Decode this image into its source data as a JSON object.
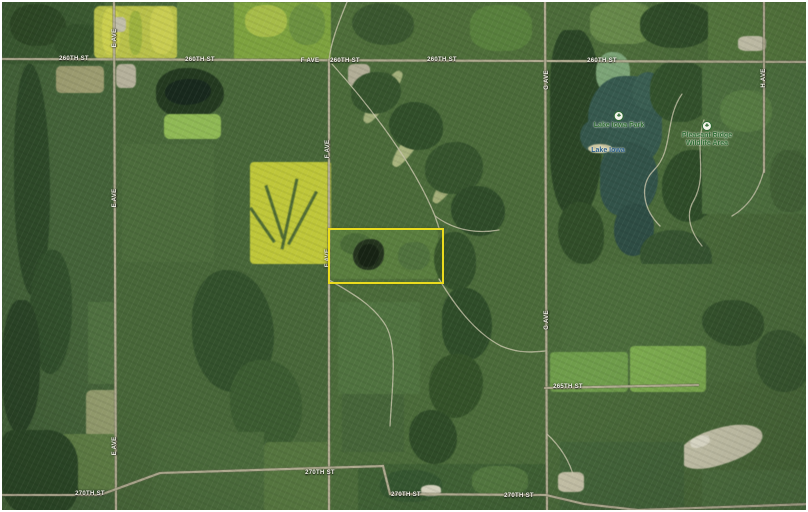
{
  "map": {
    "width": 808,
    "height": 512,
    "background_color": "#486739",
    "parcel": {
      "label": "highlighted-parcel",
      "x": 326,
      "y": 226,
      "w": 112,
      "h": 52,
      "border_color": "#eadb1e"
    },
    "road_color": "#b3ae94",
    "road_casing_color": "#6e6e59",
    "trail_color": "#c8c5ab",
    "roads_major": [
      "M0,57 L808,60",
      "M112,0 L114,512",
      "M327,58 L327,512",
      "M543,0 L545,512",
      "M762,0 L762,170",
      "M543,386 L696,383",
      "M0,493 L98,493 L158,471 L381,464 L388,492 L544,493 L582,502 L636,508 L808,502"
    ],
    "roads_minor": [
      "M345,0 C336,22 329,40 327,58",
      "M330,62 C368,104 412,162 433,214 L437,226",
      "M433,214 C452,228 474,232 497,228",
      "M437,277 C452,302 472,330 499,344 C518,352 532,350 543,349",
      "M327,278 C352,292 372,304 384,324 C396,346 390,386 388,424",
      "M680,92 C662,118 672,148 652,168 C636,184 642,208 658,224",
      "M702,118 C692,148 706,172 692,198 C682,214 690,232 700,244",
      "M762,168 C756,192 744,206 730,214",
      "M545,432 C560,446 568,460 572,476"
    ],
    "labels": [
      {
        "t": "260TH ST",
        "x": 72,
        "y": 57,
        "v": 0
      },
      {
        "t": "260TH ST",
        "x": 198,
        "y": 58,
        "v": 0
      },
      {
        "t": "F AVE",
        "x": 308,
        "y": 59,
        "v": 0
      },
      {
        "t": "260TH ST",
        "x": 343,
        "y": 59,
        "v": 0
      },
      {
        "t": "260TH ST",
        "x": 440,
        "y": 58,
        "v": 0
      },
      {
        "t": "260TH ST",
        "x": 600,
        "y": 59,
        "v": 0
      },
      {
        "t": "265TH ST",
        "x": 566,
        "y": 385,
        "v": 0
      },
      {
        "t": "270TH ST",
        "x": 88,
        "y": 492,
        "v": 0
      },
      {
        "t": "270TH ST",
        "x": 318,
        "y": 471,
        "v": 0
      },
      {
        "t": "270TH ST",
        "x": 404,
        "y": 493,
        "v": 0
      },
      {
        "t": "270TH ST",
        "x": 517,
        "y": 494,
        "v": 0
      },
      {
        "t": "E AVE",
        "x": 113,
        "y": 36,
        "v": 1
      },
      {
        "t": "E AVE",
        "x": 113,
        "y": 196,
        "v": 1
      },
      {
        "t": "E AVE",
        "x": 113,
        "y": 444,
        "v": 1
      },
      {
        "t": "F AVE",
        "x": 326,
        "y": 147,
        "v": 1
      },
      {
        "t": "F AVE",
        "x": 326,
        "y": 256,
        "v": 1
      },
      {
        "t": "G AVE",
        "x": 545,
        "y": 78,
        "v": 1
      },
      {
        "t": "G AVE",
        "x": 545,
        "y": 318,
        "v": 1
      },
      {
        "t": "H AVE",
        "x": 762,
        "y": 76,
        "v": 1
      }
    ],
    "poi": [
      {
        "name": "lake-iowa-park",
        "lines": [
          "Lake Iowa Park"
        ],
        "x": 617,
        "y": 121,
        "color": "#2e6b33",
        "icon": "tree"
      },
      {
        "name": "lake-iowa",
        "lines": [
          "Lake Iowa"
        ],
        "x": 606,
        "y": 149,
        "color": "#2c5e8a",
        "icon": ""
      },
      {
        "name": "pleasant-ridge-wildlife-area",
        "lines": [
          "Pleasant Ridge",
          "Wildlife Area"
        ],
        "x": 705,
        "y": 131,
        "color": "#2e6b33",
        "icon": "tree"
      }
    ],
    "icon_glyphs": {
      "tree": "♣"
    },
    "terrain": [
      {
        "x": 0,
        "y": 0,
        "w": 102,
        "h": 62,
        "c": "#3b5a31"
      },
      {
        "x": 8,
        "y": 2,
        "w": 56,
        "h": 42,
        "c": "#2e4926",
        "r": "45% 55% 50% 48%"
      },
      {
        "x": 52,
        "y": 22,
        "w": 46,
        "h": 36,
        "c": "#33512b",
        "r": "50% 42% 55% 45%"
      },
      {
        "x": 92,
        "y": 4,
        "w": 84,
        "h": 53,
        "c": "#b9c14a",
        "r": "6px"
      },
      {
        "x": 100,
        "y": 6,
        "w": 18,
        "h": 47,
        "c": "#ccd04f",
        "r": "40%"
      },
      {
        "x": 127,
        "y": 9,
        "w": 13,
        "h": 44,
        "c": "#9db23f",
        "r": "40%"
      },
      {
        "x": 148,
        "y": 4,
        "w": 24,
        "h": 48,
        "c": "#c9cd52",
        "r": "40%"
      },
      {
        "x": 175,
        "y": 0,
        "w": 58,
        "h": 58,
        "c": "#5d7f40"
      },
      {
        "x": 232,
        "y": 0,
        "w": 97,
        "h": 58,
        "c": "#7da23f"
      },
      {
        "x": 243,
        "y": 3,
        "w": 42,
        "h": 32,
        "c": "#a6bc49",
        "r": "45%"
      },
      {
        "x": 287,
        "y": 1,
        "w": 36,
        "h": 42,
        "c": "#6c9140",
        "r": "45%"
      },
      {
        "x": 330,
        "y": 0,
        "w": 212,
        "h": 58,
        "c": "#4e6e3a"
      },
      {
        "x": 350,
        "y": 1,
        "w": 62,
        "h": 42,
        "c": "#3a572f",
        "r": "48% 52% 45% 55%"
      },
      {
        "x": 468,
        "y": 3,
        "w": 62,
        "h": 46,
        "c": "#58803d",
        "r": "40%"
      },
      {
        "x": 542,
        "y": 0,
        "w": 266,
        "h": 60,
        "c": "#4c6c3a"
      },
      {
        "x": 588,
        "y": 0,
        "w": 64,
        "h": 42,
        "c": "#67894a",
        "r": "35%"
      },
      {
        "x": 638,
        "y": 0,
        "w": 72,
        "h": 46,
        "c": "#304d29",
        "r": "45%"
      },
      {
        "x": 706,
        "y": 0,
        "w": 102,
        "h": 58,
        "c": "#56793f"
      },
      {
        "x": 0,
        "y": 62,
        "w": 112,
        "h": 450,
        "c": "#446339"
      },
      {
        "x": 12,
        "y": 62,
        "w": 36,
        "h": 232,
        "c": "#2e4a29",
        "r": "42% 58% 46% 54%"
      },
      {
        "x": 28,
        "y": 248,
        "w": 42,
        "h": 124,
        "c": "#32502c",
        "r": "50% 45% 55% 50%"
      },
      {
        "x": 0,
        "y": 298,
        "w": 38,
        "h": 132,
        "c": "#2b4527",
        "r": "45% 40% 50% 42%"
      },
      {
        "x": 54,
        "y": 64,
        "w": 48,
        "h": 27,
        "c": "#9c9c70",
        "r": "5px"
      },
      {
        "x": 86,
        "y": 300,
        "w": 42,
        "h": 82,
        "c": "#4f7040"
      },
      {
        "x": 84,
        "y": 388,
        "w": 53,
        "h": 48,
        "c": "#939c6d",
        "r": "6px"
      },
      {
        "x": 58,
        "y": 432,
        "w": 72,
        "h": 56,
        "c": "#5f7e45",
        "r": "5px"
      },
      {
        "x": 0,
        "y": 428,
        "w": 76,
        "h": 84,
        "c": "#2c4827",
        "r": "15% 40% 30% 35%"
      },
      {
        "x": 114,
        "y": 60,
        "w": 214,
        "h": 452,
        "c": "#486739"
      },
      {
        "x": 114,
        "y": 62,
        "w": 20,
        "h": 24,
        "c": "#b5b19b",
        "r": "25%"
      },
      {
        "x": 111,
        "y": 15,
        "w": 13,
        "h": 15,
        "c": "#c2bfa9",
        "r": "30%"
      },
      {
        "x": 154,
        "y": 66,
        "w": 68,
        "h": 50,
        "c": "#243a20",
        "r": "45% 55% 50% 45%"
      },
      {
        "x": 163,
        "y": 77,
        "w": 46,
        "h": 26,
        "c": "#18291d",
        "r": "55% 45% 60% 50%"
      },
      {
        "x": 162,
        "y": 112,
        "w": 57,
        "h": 25,
        "c": "#8fb955",
        "r": "6px"
      },
      {
        "x": 120,
        "y": 142,
        "w": 92,
        "h": 118,
        "c": "#4c6c3c"
      },
      {
        "x": 248,
        "y": 160,
        "w": 82,
        "h": 102,
        "c": "#bfc73a",
        "r": "4px"
      },
      {
        "x": 286,
        "y": 176,
        "w": 3,
        "h": 72,
        "c": "#4e6a33",
        "rot": 12
      },
      {
        "x": 271,
        "y": 182,
        "w": 3,
        "h": 56,
        "c": "#4e6a33",
        "rot": -18
      },
      {
        "x": 299,
        "y": 186,
        "w": 3,
        "h": 60,
        "c": "#4e6a33",
        "rot": 28
      },
      {
        "x": 259,
        "y": 202,
        "w": 3,
        "h": 42,
        "c": "#4e6a33",
        "rot": -35
      },
      {
        "x": 190,
        "y": 268,
        "w": 82,
        "h": 122,
        "c": "#33512c",
        "r": "40% 55% 45% 50%"
      },
      {
        "x": 228,
        "y": 358,
        "w": 72,
        "h": 92,
        "c": "#3c5c31",
        "r": "40% 50% 45% 55%"
      },
      {
        "x": 150,
        "y": 430,
        "w": 112,
        "h": 82,
        "c": "#4a6a3b"
      },
      {
        "x": 262,
        "y": 440,
        "w": 82,
        "h": 72,
        "c": "#55753f",
        "r": "5px"
      },
      {
        "x": 329,
        "y": 60,
        "w": 214,
        "h": 452,
        "c": "#4b6b3a"
      },
      {
        "x": 346,
        "y": 62,
        "w": 22,
        "h": 22,
        "c": "#b2ae97",
        "r": "25%"
      },
      {
        "x": 374,
        "y": 64,
        "w": 14,
        "h": 62,
        "c": "#a3b07b",
        "r": "40%",
        "rot": 35
      },
      {
        "x": 404,
        "y": 104,
        "w": 14,
        "h": 66,
        "c": "#a9b47e",
        "r": "40%",
        "rot": 35
      },
      {
        "x": 443,
        "y": 146,
        "w": 13,
        "h": 60,
        "c": "#a3ae78",
        "r": "40%",
        "rot": 35
      },
      {
        "x": 349,
        "y": 70,
        "w": 50,
        "h": 42,
        "c": "#36542d",
        "r": "50% 44% 55% 46%"
      },
      {
        "x": 387,
        "y": 100,
        "w": 54,
        "h": 48,
        "c": "#314f2a",
        "r": "48% 54% 44% 56%"
      },
      {
        "x": 423,
        "y": 140,
        "w": 58,
        "h": 52,
        "c": "#36542d",
        "r": "52% 46% 50% 44%"
      },
      {
        "x": 449,
        "y": 184,
        "w": 54,
        "h": 50,
        "c": "#2f4c29",
        "r": "46% 52% 48% 54%"
      },
      {
        "x": 328,
        "y": 227,
        "w": 108,
        "h": 50,
        "c": "#577c41",
        "r": "3px"
      },
      {
        "x": 338,
        "y": 231,
        "w": 32,
        "h": 22,
        "c": "#486a3a",
        "r": "50%"
      },
      {
        "x": 396,
        "y": 240,
        "w": 32,
        "h": 28,
        "c": "#4d7040",
        "r": "45%"
      },
      {
        "x": 351,
        "y": 237,
        "w": 31,
        "h": 31,
        "c": "#20301f",
        "r": "58% 42% 52% 48%"
      },
      {
        "x": 356,
        "y": 242,
        "w": 21,
        "h": 23,
        "c": "#131f15",
        "r": "55% 48% 58% 45%"
      },
      {
        "x": 432,
        "y": 230,
        "w": 42,
        "h": 58,
        "c": "#33512b",
        "r": "45% 50% 42% 55%"
      },
      {
        "x": 440,
        "y": 286,
        "w": 50,
        "h": 72,
        "c": "#2f4d29",
        "r": "40% 55% 50% 45%"
      },
      {
        "x": 427,
        "y": 352,
        "w": 54,
        "h": 64,
        "c": "#345229",
        "r": "50% 44% 55% 46%"
      },
      {
        "x": 407,
        "y": 408,
        "w": 48,
        "h": 54,
        "c": "#2f4c28",
        "r": "45% 52% 46% 54%"
      },
      {
        "x": 336,
        "y": 300,
        "w": 82,
        "h": 92,
        "c": "#507340"
      },
      {
        "x": 340,
        "y": 392,
        "w": 62,
        "h": 58,
        "c": "#466539"
      },
      {
        "x": 356,
        "y": 462,
        "w": 188,
        "h": 50,
        "c": "#3f6034"
      },
      {
        "x": 378,
        "y": 468,
        "w": 62,
        "h": 32,
        "c": "#355630",
        "r": "45%"
      },
      {
        "x": 470,
        "y": 464,
        "w": 56,
        "h": 30,
        "c": "#52763f",
        "r": "40%"
      },
      {
        "x": 419,
        "y": 483,
        "w": 20,
        "h": 11,
        "c": "#d2cfbb",
        "r": "40%"
      },
      {
        "x": 545,
        "y": 60,
        "w": 263,
        "h": 452,
        "c": "#4a6a3a"
      },
      {
        "x": 548,
        "y": 28,
        "w": 52,
        "h": 184,
        "c": "#2b4626",
        "r": "30% 45% 40% 35%"
      },
      {
        "x": 556,
        "y": 200,
        "w": 46,
        "h": 62,
        "c": "#314e29",
        "r": "45% 50% 40% 55%"
      },
      {
        "x": 594,
        "y": 50,
        "w": 34,
        "h": 42,
        "c": "#7ca477",
        "r": "45%"
      },
      {
        "x": 586,
        "y": 74,
        "w": 74,
        "h": 88,
        "c": "#36594e",
        "r": "55% 45% 40% 60%"
      },
      {
        "x": 630,
        "y": 70,
        "w": 32,
        "h": 38,
        "c": "#3a5e52",
        "r": "50%"
      },
      {
        "x": 578,
        "y": 118,
        "w": 28,
        "h": 32,
        "c": "#35574c",
        "r": "50%"
      },
      {
        "x": 598,
        "y": 140,
        "w": 58,
        "h": 74,
        "c": "#325349",
        "r": "45% 55% 58% 42%"
      },
      {
        "x": 612,
        "y": 202,
        "w": 40,
        "h": 52,
        "c": "#2e4d44",
        "r": "50% 45% 55% 50%"
      },
      {
        "x": 586,
        "y": 142,
        "w": 24,
        "h": 9,
        "c": "#cfc9a2",
        "r": "50%"
      },
      {
        "x": 648,
        "y": 58,
        "w": 62,
        "h": 62,
        "c": "#33522c",
        "r": "45% 52% 48% 44%"
      },
      {
        "x": 660,
        "y": 148,
        "w": 58,
        "h": 72,
        "c": "#2f4d29",
        "r": "50% 40% 55% 45%"
      },
      {
        "x": 638,
        "y": 228,
        "w": 72,
        "h": 52,
        "c": "#365430",
        "r": "45% 55% 42% 52%"
      },
      {
        "x": 700,
        "y": 60,
        "w": 108,
        "h": 152,
        "c": "#4f7240"
      },
      {
        "x": 718,
        "y": 88,
        "w": 52,
        "h": 42,
        "c": "#5b8146",
        "r": "45%"
      },
      {
        "x": 768,
        "y": 148,
        "w": 40,
        "h": 62,
        "c": "#456538",
        "r": "40%"
      },
      {
        "x": 736,
        "y": 34,
        "w": 28,
        "h": 15,
        "c": "#c9c6ae",
        "r": "30%"
      },
      {
        "x": 560,
        "y": 262,
        "w": 240,
        "h": 118,
        "c": "#4c6d3c"
      },
      {
        "x": 548,
        "y": 350,
        "w": 78,
        "h": 40,
        "c": "#6f9d4b",
        "r": "4px"
      },
      {
        "x": 628,
        "y": 344,
        "w": 76,
        "h": 46,
        "c": "#7cab4f",
        "r": "4px"
      },
      {
        "x": 700,
        "y": 298,
        "w": 62,
        "h": 46,
        "c": "#35532d",
        "r": "45% 50% 42% 55%"
      },
      {
        "x": 754,
        "y": 328,
        "w": 54,
        "h": 62,
        "c": "#3a5931",
        "r": "40% 52% 44% 50%"
      },
      {
        "x": 676,
        "y": 426,
        "w": 86,
        "h": 36,
        "c": "#c9c7ad",
        "r": "45% 55% 50% 45%",
        "rot": -18
      },
      {
        "x": 688,
        "y": 434,
        "w": 20,
        "h": 11,
        "c": "#e4e2cf",
        "r": "40%",
        "rot": -18
      },
      {
        "x": 558,
        "y": 440,
        "w": 124,
        "h": 72,
        "c": "#44653a"
      },
      {
        "x": 556,
        "y": 470,
        "w": 26,
        "h": 20,
        "c": "#c6c2a8",
        "r": "25%"
      },
      {
        "x": 700,
        "y": 468,
        "w": 108,
        "h": 44,
        "c": "#4e7040"
      }
    ]
  }
}
